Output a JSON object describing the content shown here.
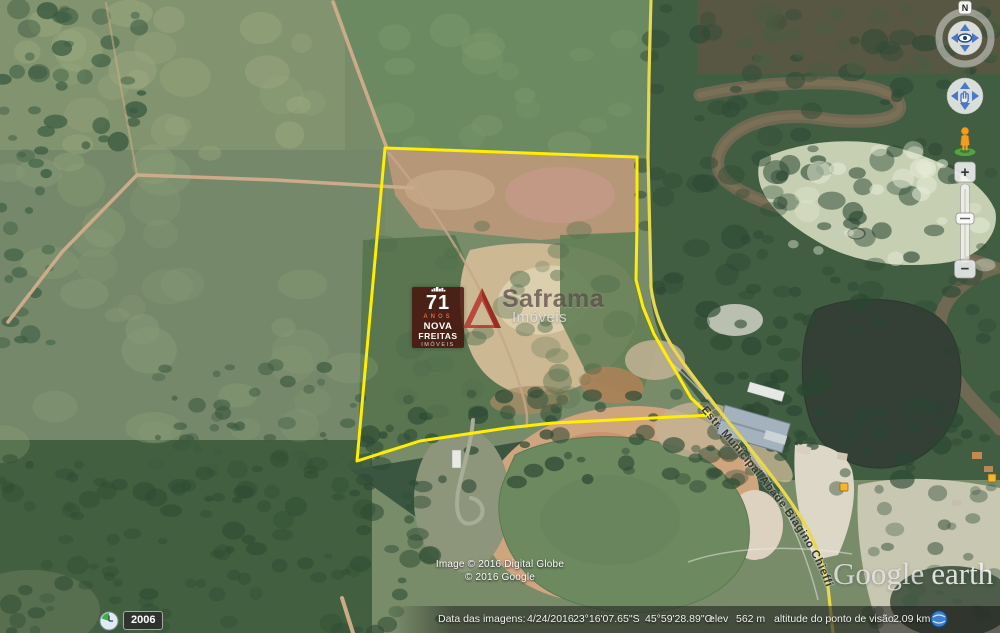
{
  "map": {
    "road_label": "Estr. Municipal Abade Biagino Chieffi",
    "boundary_color": "#ffee00",
    "road_color": "#e9d84c"
  },
  "watermarks": {
    "nova_freitas": {
      "years": "71",
      "anos": "ANOS",
      "name_line1": "NOVA",
      "name_line2": "FREITAS",
      "name_line3": "IMÓVEIS"
    },
    "saframa": {
      "name": "Saframa",
      "tagline": "Imóveis",
      "accent_color": "#b23228"
    }
  },
  "controls": {
    "compass_n": "N",
    "zoom_in": "+",
    "zoom_out": "−",
    "history_year": "2006"
  },
  "branding": {
    "logo_part1": "Google",
    "logo_part2": "earth"
  },
  "attribution": {
    "line1": "Image © 2016 Digital Globe",
    "line2": "© 2016 Google"
  },
  "status_bar": {
    "imagery_date_label": "Data das imagens:",
    "imagery_date": "4/24/2016",
    "latitude": "23°16'07.65\"S",
    "longitude": "45°59'28.89\"O",
    "elevation_label": "elev",
    "elevation": "562 m",
    "eye_altitude_label": "altitude do ponto de visão",
    "eye_altitude": "2.09 km"
  }
}
